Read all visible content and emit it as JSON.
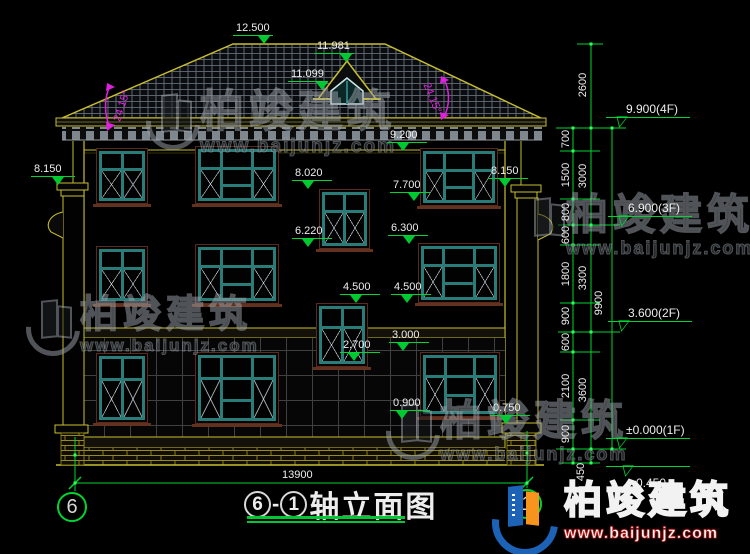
{
  "title": {
    "axis_from": "6",
    "separator": "-",
    "axis_to": "1",
    "name": "轴立面图"
  },
  "axes": {
    "left_bubble": "6",
    "right_bubble": "1"
  },
  "dimensions": {
    "overall_width": "13900",
    "right_detail_chain": [
      "700",
      "1500",
      "800",
      "600",
      "1800",
      "900",
      "600",
      "2100",
      "900"
    ],
    "right_floor_chain": [
      "2600",
      "3000",
      "3300",
      "3600"
    ],
    "right_total": "9900",
    "foundation_offset": "450"
  },
  "levels": {
    "f4": "9.900(4F)",
    "f3": "6.900(3F)",
    "f2": "3.600(2F)",
    "f1": "±0.000(1F)",
    "ground": "-0.450"
  },
  "marks": {
    "ridge": "12.500",
    "dormer_ridge": "11.981",
    "dormer_eave": "11.099",
    "eave_trim": "9.200",
    "pilaster_left": "8.150",
    "pilaster_right": "8.150",
    "stair_win3_head": "8.020",
    "stair_win3_sill": "6.220",
    "win3_head": "7.700",
    "win3_sill": "6.300",
    "stair_win2_head": "4.500",
    "win2_sill": "4.500",
    "win1_head": "3.000",
    "stair_win2_sill": "2.700",
    "win1_sill": "0.900",
    "pedestal_top": "0.750"
  },
  "roof": {
    "slope_left": "24.15°",
    "slope_right": "24.15°"
  },
  "watermark": {
    "brand": "柏竣建筑",
    "site": "www.baijunjz.com"
  },
  "logo": {
    "brand": "柏竣建筑",
    "site": "www.baijunjz.com"
  },
  "colors": {
    "dimension_green": "#00d432",
    "outline_yellow": "#c9be2e",
    "window_teal": "#2a7c78",
    "slope_magenta": "#e020e0"
  }
}
